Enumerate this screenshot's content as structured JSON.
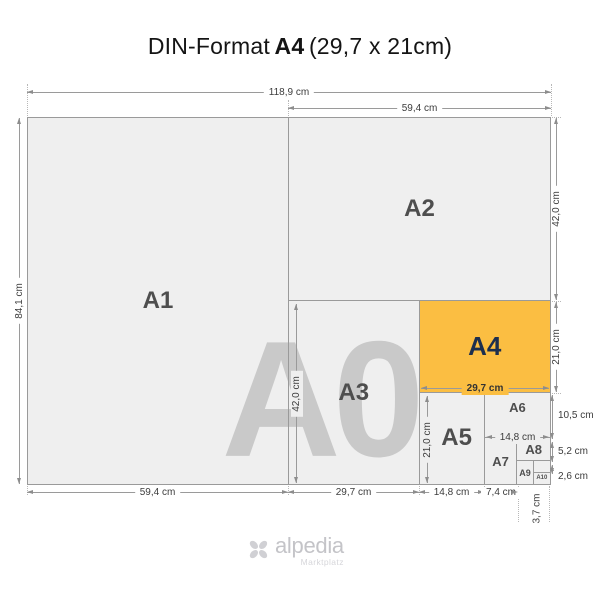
{
  "title": {
    "prefix": "DIN-Format",
    "format": "A4",
    "suffix": "(29,7 x 21cm)"
  },
  "watermark": "A0",
  "formats": {
    "a1": "A1",
    "a2": "A2",
    "a3": "A3",
    "a4": "A4",
    "a5": "A5",
    "a6": "A6",
    "a7": "A7",
    "a8": "A8",
    "a9": "A9",
    "a10": "A10"
  },
  "dims": {
    "top_full": "118,9 cm",
    "top_half": "59,4 cm",
    "left": "84,1 cm",
    "right_a2": "42,0 cm",
    "right_a4": "21,0 cm",
    "right_a6": "10,5 cm",
    "right_a8": "5,2 cm",
    "right_a10": "2,6 cm",
    "bottom_a1": "59,4 cm",
    "bottom_a3": "29,7 cm",
    "bottom_a5": "14,8 cm",
    "bottom_a7": "7,4 cm",
    "bottom_a9": "3,7 cm",
    "inner_a3": "42,0 cm",
    "inner_a4": "29,7 cm",
    "inner_a5": "21,0 cm",
    "inner_a6": "14,8 cm"
  },
  "logo": {
    "name": "alpedia",
    "subtitle": "Marktplatz"
  },
  "colors": {
    "paper": "#efefef",
    "paper_border": "#9a9a9a",
    "highlight": "#FBBE42",
    "highlight_text": "#1d2f4e",
    "format_label": "#4e4e4e",
    "watermark": "#c9c9c9",
    "dim_text": "#3c3c3c",
    "logo": "#c4c4c8"
  }
}
